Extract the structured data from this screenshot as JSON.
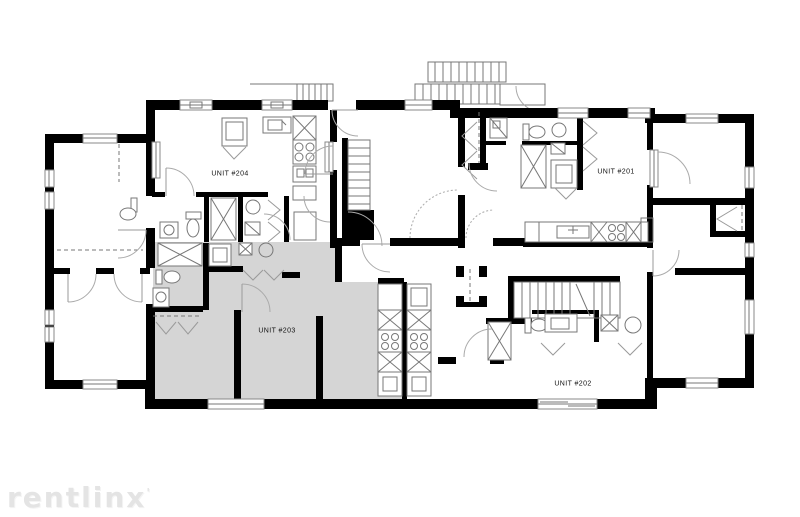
{
  "page": {
    "background": "#ffffff"
  },
  "floor_plan": {
    "type": "apartment-building-floor-plan",
    "wall_color": "#000000",
    "highlight_color": "#d5d5d5",
    "units": [
      {
        "id": "204",
        "label": "UNIT #204",
        "highlighted": false
      },
      {
        "id": "201",
        "label": "UNIT #201",
        "highlighted": false
      },
      {
        "id": "203",
        "label": "UNIT #203",
        "highlighted": true
      },
      {
        "id": "202",
        "label": "UNIT #202",
        "highlighted": false
      }
    ]
  },
  "watermark": {
    "text": "rentlinx",
    "mark": "'"
  }
}
